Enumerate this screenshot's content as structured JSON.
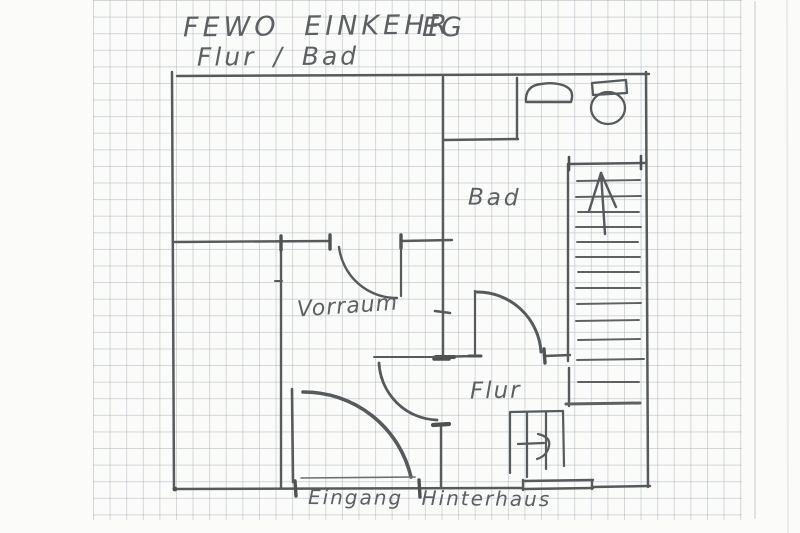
{
  "sheet": {
    "title": "FEWO EINKEHR",
    "floor_tag": "EG",
    "subtitle": "Flur / Bad"
  },
  "floorplan": {
    "rooms": [
      {
        "label": "Bad"
      },
      {
        "label": "Vorraum"
      },
      {
        "label": "Flur"
      }
    ],
    "entrance_label": "Eingang Hinterhaus",
    "fixtures": [
      "sink-icon",
      "toilet-icon",
      "stairs-up-arrow-icon",
      "stairs-right-arrow-icon"
    ],
    "colors": {
      "pencil": "#565a5c",
      "grid_line": "#c9d1d6",
      "paper": "#fbfbf9"
    }
  }
}
